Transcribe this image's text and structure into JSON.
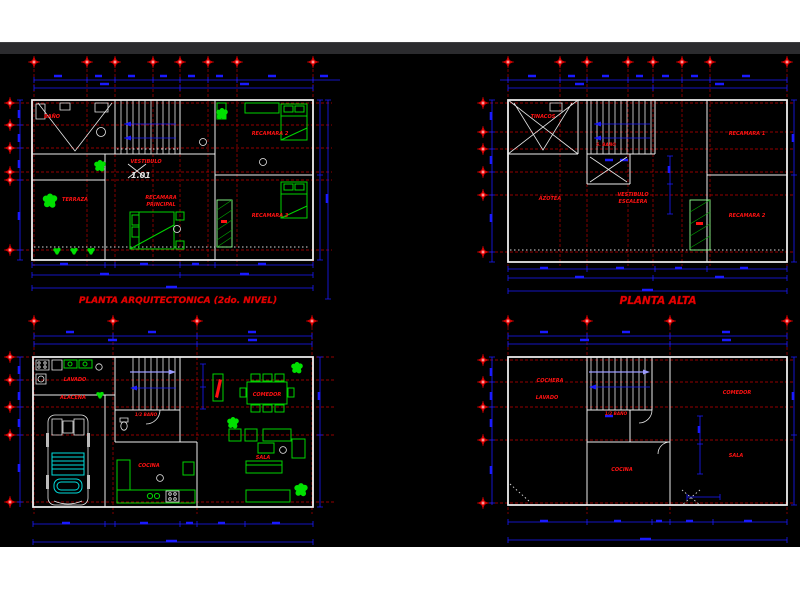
{
  "colors": {
    "page_bg": "#ffffff",
    "toolbar": "#2b2b2e",
    "canvas_bg": "#000000",
    "wall": "#ededed",
    "axis": "#c40000",
    "dim": "#1a1aff",
    "furniture": "#00d400",
    "hatch": "#00a000",
    "label": "#ff1212",
    "car_accent": "#00dcdc",
    "stair_arrow": "#9a9aff"
  },
  "plans": {
    "second_level": {
      "title": "PLANTA ARQUITECTONICA (2do. NIVEL)",
      "level_mark": "1.01",
      "labels": {
        "bath": "BAÑO",
        "hall": "VESTIBULO",
        "master_line1": "RECAMARA",
        "master_line2": "PRINCIPAL",
        "terrace": "TERRAZA",
        "bedroom2": "RECAMARA 2",
        "bedroom3": "RECAMARA 3"
      }
    },
    "planta_alta": {
      "title": "PLANTA ALTA",
      "labels": {
        "tanks": "TINACOS",
        "bath": "S. BAÑO",
        "hall_line1": "VESTIBULO",
        "hall_line2": "ESCALERA",
        "roof": "AZOTEA",
        "bedroom1": "RECAMARA 1",
        "bedroom2": "RECAMARA 2"
      }
    },
    "ground_level": {
      "labels": {
        "laundry": "LAVADO",
        "pantry": "ALACENA",
        "half_bath": "1/2 BAÑO",
        "kitchen": "COCINA",
        "dining": "COMEDOR",
        "living": "SALA"
      }
    },
    "planta_baja": {
      "labels": {
        "garage": "COCHERA",
        "laundry": "LAVADO",
        "half_bath": "1/2 BAÑO",
        "kitchen": "COCINA",
        "dining": "COMEDOR",
        "living": "SALA"
      }
    }
  }
}
